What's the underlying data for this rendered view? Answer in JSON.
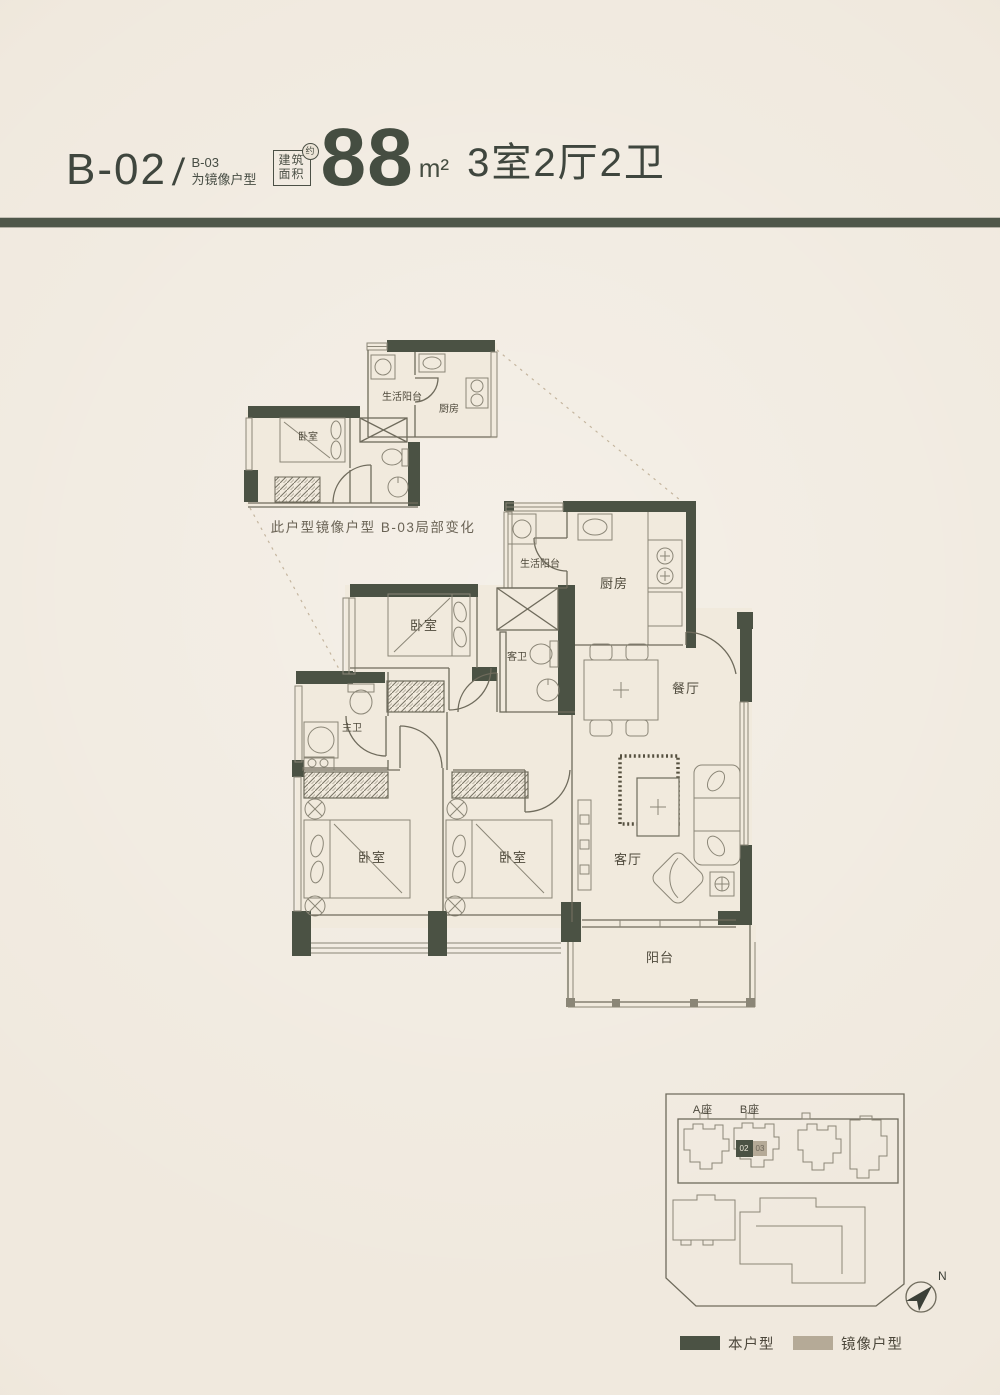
{
  "colors": {
    "background": "#ece4d7",
    "accent_dark": "#4b5244",
    "mirror_tan": "#b5aa97",
    "ink": "#3f463e"
  },
  "header": {
    "unit_code": "B-02",
    "separator": "/",
    "mirror_code": "B-03",
    "mirror_note": "为镜像户型",
    "area_box_line1": "建筑",
    "area_box_line2": "面积",
    "area_approx": "约",
    "area_value": "88",
    "area_unit": "m²",
    "rooms_summary": "3室2厅2卫"
  },
  "inset_plan": {
    "caption": "此户型镜像户型 B-03局部变化",
    "labels": {
      "bedroom": "卧室",
      "service_balcony": "生活阳台",
      "kitchen": "厨房"
    }
  },
  "main_plan": {
    "labels": {
      "service_balcony": "生活阳台",
      "kitchen": "厨房",
      "bedroom_top": "卧室",
      "guest_bath": "客卫",
      "dining": "餐厅",
      "master_bath": "主卫",
      "bedroom_left": "卧室",
      "bedroom_middle": "卧室",
      "living": "客厅",
      "balcony": "阳台"
    }
  },
  "site_plan": {
    "tower_a_label": "A座",
    "tower_b_label": "B座",
    "unit_number": "02",
    "mirror_unit_number": "03",
    "compass_label": "N"
  },
  "legend": {
    "this_unit_label": "本户型",
    "mirror_unit_label": "镜像户型"
  }
}
